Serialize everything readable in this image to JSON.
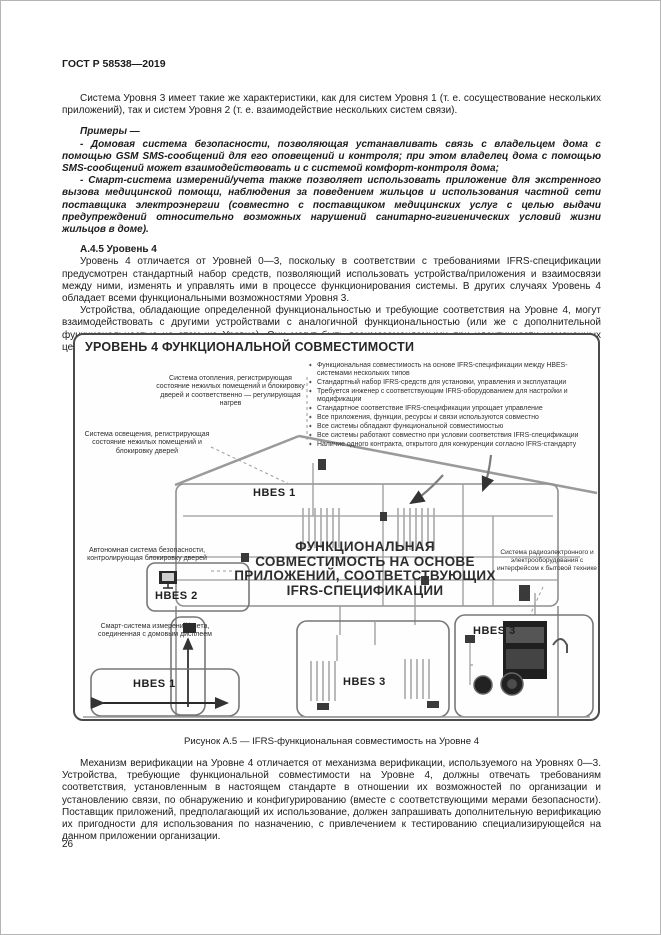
{
  "page": {
    "header": "ГОСТ Р 58538—2019",
    "number": "26"
  },
  "doc": {
    "p1": "Система Уровня 3 имеет такие же характеристики, как для систем Уровня 1 (т. е. сосуществование нескольких приложений), так и систем Уровня 2 (т. е. взаимодействие нескольких систем связи).",
    "examples_lead": "Примеры —",
    "example1": "- Домовая система безопасности, позволяющая устанавливать связь с владельцем дома с помощью GSM SMS-сообщений для его оповещений и контроля; при этом владелец дома с помощью SMS-сообщений может взаимодействовать и с системой комфорт-контроля дома;",
    "example2": "- Смарт-система измерений/учета также позволяет использовать приложение для экстренного вызова медицинской помощи, наблюдения за поведением жильцов и использования частной сети поставщика электроэнергии (совместно с поставщиком медицинских услуг с целью выдачи предупреждений относительно возможных нарушений санитарно-гигиенических условий жизни жильцов в доме).",
    "heading": "А.4.5 Уровень 4",
    "p2": "Уровень 4 отличается от Уровней 0—3, поскольку в соответствии с требованиями IFRS-спецификации предусмотрен стандартный набор средств, позволяющий использовать устройства/приложения и взаимосвязи между ними, изменять и управлять ими в процессе функционирования системы. В других случаях Уровень 4 обладает всеми функциональными возможностями Уровня 3.",
    "p3": "Устройства, обладающие определенной функциональностью и требующие соответствия на Уровне 4, могут взаимодействовать с другими устройствами с аналогичной функциональностью (или же с дополнительной функциональностью на этом же Уровне). Они могут быть взаимозаменяемыми при идентичности намеченных целей.",
    "p4": "Механизм верификации на Уровне 4 отличается от механизма верификации, используемого на Уровнях 0—3. Устройства, требующие функциональной совместимости на Уровне 4, должны отвечать требованиям соответствия, установленным в настоящем стандарте в отношении их возможностей по организации и установлению связи, по обнаружению и конфигурированию (вместе с соответствующими мерами безопасности). Поставщик приложений, предполагающий их использование, должен запрашивать дополнительную верификацию их пригодности для использования по назначению, с привлечением к тестированию специализирующейся на данном приложении организации."
  },
  "figure": {
    "title": "УРОВЕНЬ 4 ФУНКЦИОНАЛЬНОЙ СОВМЕСТИМОСТИ",
    "caption": "Рисунок А.5 — IFRS-функциональная совместимость на Уровне 4",
    "bullet_char": "✦",
    "bullets": [
      "Функциональная совместимость на основе IFRS-спецификации между HBES-системами нескольких типов",
      "Стандартный набор IFRS-средств для установки, управления и эксплуатации",
      "Требуется инженер с соответствующим IFRS-оборудованием для настройки и модификации",
      "Стандартное соответствие IFRS-спецификации упрощает управление",
      "Все приложения, функции, ресурсы и связи используются совместно",
      "Все системы обладают функциональной совместимостью",
      "Все системы работают совместно при условии соответствия IFRS-спецификации",
      "Наличие одного контракта, открытого для конкуренции согласно IFRS-стандарту"
    ],
    "labels": {
      "heating": "Система отопления, регистрирующая состояние нежилых помещений и блокировку дверей и соответственно — регулирующая нагрев",
      "lighting": "Система освещения, регистрирующая состояние нежилых помещений и блокировку дверей",
      "security": "Автономная система безопасности, контролирующая блокировку дверей",
      "meter": "Смарт-система измерений/учета, соединенная с домовым дисплеем",
      "appliances": "Система радиоэлектронного и электрооборудования с интерфейсом к бытовой технике"
    },
    "central": [
      "ФУНКЦИОНАЛЬНАЯ",
      "СОВМЕСТИМОСТЬ НА ОСНОВЕ",
      "ПРИЛОЖЕНИЙ, СООТВЕТСТВУЮЩИХ",
      "IFRS-СПЕЦИФИКАЦИИ"
    ],
    "hbes": {
      "top": "HBES 1",
      "left": "HBES 2",
      "bottom_left": "HBES 1",
      "bottom_mid": "HBES 3",
      "right_box": "HBES 3"
    }
  },
  "colors": {
    "text": "#1c1c1c",
    "diagram_line": "#8f8f8f",
    "diagram_dark": "#2a2a2a",
    "figure_border": "#4a4a4a"
  }
}
